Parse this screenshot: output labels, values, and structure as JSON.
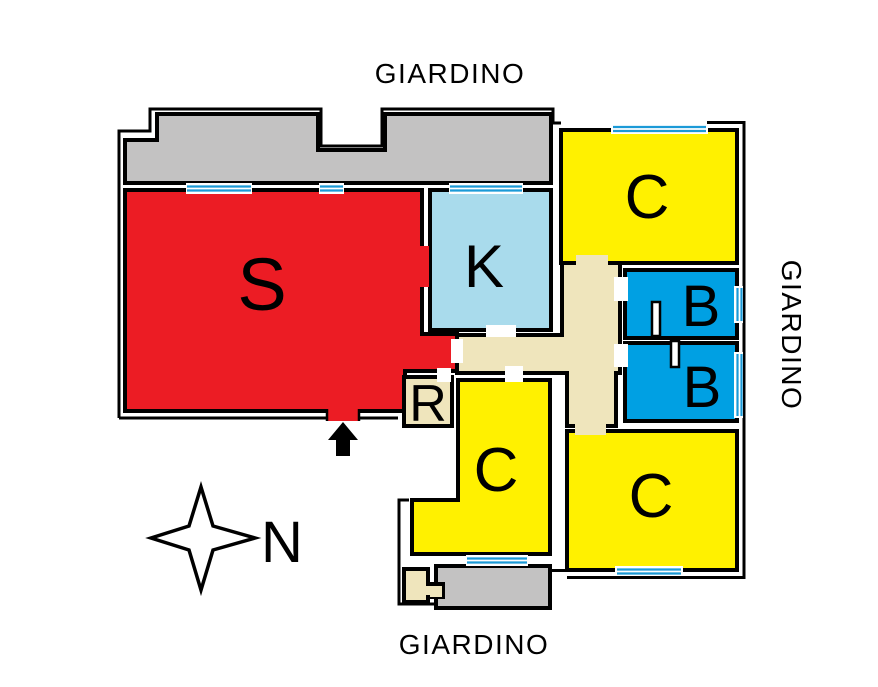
{
  "plan_labels": {
    "garden_top": "GIARDINO",
    "garden_right": "GIARDINO",
    "garden_bottom": "GIARDINO",
    "north": "N"
  },
  "rooms": {
    "living": "S",
    "kitchen": "K",
    "bedroom_top": "C",
    "bedroom_middle": "C",
    "bedroom_bottom_right": "C",
    "bathroom_top": "B",
    "bathroom_bottom": "B",
    "storage": "R"
  },
  "colors": {
    "living_red": "#EC1C24",
    "bedroom_yellow": "#FFF100",
    "bathroom_blue": "#00A0E3",
    "kitchen_light_blue": "#A9DBEC",
    "hallway_beige": "#EFE5BC",
    "terrace_gray": "#C3C2C2",
    "window_blue": "#1B9AD7",
    "wall_black": "#000000",
    "background_white": "#FFFFFF"
  }
}
